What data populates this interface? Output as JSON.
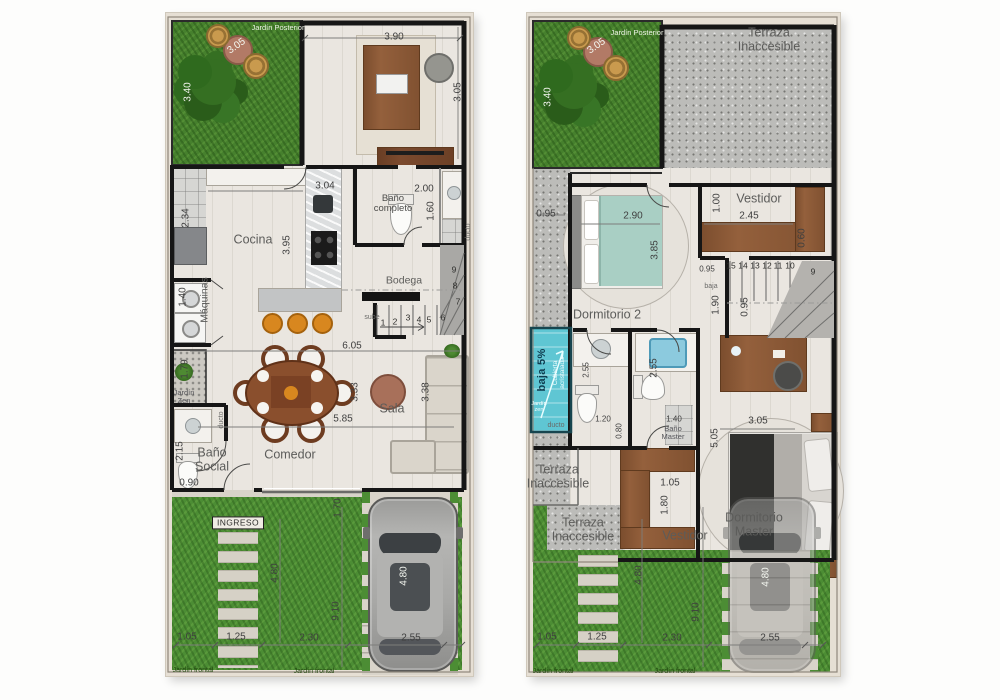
{
  "colors": {
    "grass": "#46802d",
    "front_grass": "#4c8d34",
    "concrete": "#bcbcb9",
    "wall": "#161616",
    "wood": "#94603c",
    "skylight_glass": "#5fc6d3",
    "interior_floor": "#eae6e0"
  },
  "plans": [
    {
      "id": "ground-floor",
      "labels": [
        {
          "t": "Jardín Posterior",
          "x": 112,
          "y": 15,
          "k": "tinyw"
        },
        {
          "t": "3.05",
          "x": 71,
          "y": 34,
          "k": "dimw",
          "r": -35
        },
        {
          "t": "3.40",
          "x": 23,
          "y": 79,
          "k": "dimw",
          "r": -90
        },
        {
          "t": "3.90",
          "x": 228,
          "y": 25,
          "k": "dim"
        },
        {
          "t": "3.05",
          "x": 293,
          "y": 79,
          "k": "dim",
          "r": -90
        },
        {
          "t": "3.04",
          "x": 159,
          "y": 174,
          "k": "dim"
        },
        {
          "t": "Baño\ncompleto",
          "x": 227,
          "y": 191,
          "k": "room2-sm"
        },
        {
          "t": "2.00",
          "x": 258,
          "y": 177,
          "k": "dim"
        },
        {
          "t": "1.60",
          "x": 266,
          "y": 198,
          "k": "dim",
          "r": -90
        },
        {
          "t": "ducto",
          "x": 303,
          "y": 219,
          "k": "tiny",
          "r": -90
        },
        {
          "t": "Cocina",
          "x": 87,
          "y": 227,
          "k": "room"
        },
        {
          "t": "3.95",
          "x": 122,
          "y": 232,
          "k": "dim",
          "r": -90
        },
        {
          "t": "2.34",
          "x": 21,
          "y": 205,
          "k": "dim",
          "r": -90
        },
        {
          "t": "1.40",
          "x": 18,
          "y": 284,
          "k": "dim",
          "r": -90
        },
        {
          "t": "Máquinas",
          "x": 39,
          "y": 287,
          "k": "room-sm",
          "r": -90
        },
        {
          "t": "Bodega",
          "x": 238,
          "y": 268,
          "k": "room-sm"
        },
        {
          "t": "sube",
          "x": 206,
          "y": 305,
          "k": "tiny"
        },
        {
          "t": "1",
          "x": 217,
          "y": 310,
          "k": "step"
        },
        {
          "t": "2",
          "x": 229,
          "y": 309,
          "k": "step"
        },
        {
          "t": "3",
          "x": 242,
          "y": 305,
          "k": "step"
        },
        {
          "t": "4",
          "x": 253,
          "y": 307,
          "k": "step"
        },
        {
          "t": "5",
          "x": 263,
          "y": 307,
          "k": "step"
        },
        {
          "t": "6",
          "x": 277,
          "y": 305,
          "k": "step"
        },
        {
          "t": "7",
          "x": 292,
          "y": 289,
          "k": "step"
        },
        {
          "t": "8",
          "x": 289,
          "y": 273,
          "k": "step"
        },
        {
          "t": "9",
          "x": 288,
          "y": 257,
          "k": "step"
        },
        {
          "t": "6.05",
          "x": 186,
          "y": 334,
          "k": "dim"
        },
        {
          "t": "5.85",
          "x": 177,
          "y": 407,
          "k": "dim"
        },
        {
          "t": "3.33",
          "x": 190,
          "y": 379,
          "k": "dim",
          "r": -90
        },
        {
          "t": "3.38",
          "x": 261,
          "y": 379,
          "k": "dim",
          "r": -90
        },
        {
          "t": "Sala",
          "x": 226,
          "y": 396,
          "k": "room"
        },
        {
          "t": "Comedor",
          "x": 124,
          "y": 442,
          "k": "room"
        },
        {
          "t": "Baño\nSocial",
          "x": 46,
          "y": 447,
          "k": "room2"
        },
        {
          "t": "2.15",
          "x": 15,
          "y": 438,
          "k": "dim",
          "r": -90
        },
        {
          "t": "0.90",
          "x": 23,
          "y": 471,
          "k": "dim"
        },
        {
          "t": "1.79",
          "x": 20,
          "y": 356,
          "k": "dim",
          "r": -90
        },
        {
          "t": "Jardín\nZen",
          "x": 18,
          "y": 384,
          "k": "tiny2"
        },
        {
          "t": "ducto",
          "x": 56,
          "y": 407,
          "k": "tiny",
          "r": -90
        },
        {
          "t": "INGRESO",
          "x": 72,
          "y": 510,
          "k": "ingreso"
        },
        {
          "t": "1.05",
          "x": 21,
          "y": 625,
          "k": "dim"
        },
        {
          "t": "1.25",
          "x": 70,
          "y": 625,
          "k": "dim"
        },
        {
          "t": "2.30",
          "x": 143,
          "y": 626,
          "k": "dim"
        },
        {
          "t": "2.55",
          "x": 245,
          "y": 626,
          "k": "dim"
        },
        {
          "t": "4.80",
          "x": 110,
          "y": 560,
          "k": "dim",
          "r": -90
        },
        {
          "t": "9.10",
          "x": 171,
          "y": 598,
          "k": "dim",
          "r": -90
        },
        {
          "t": "1.70",
          "x": 173,
          "y": 495,
          "k": "dim",
          "r": -90
        },
        {
          "t": "4.80",
          "x": 239,
          "y": 563,
          "k": "dimw",
          "r": -90
        },
        {
          "t": "Jardín frontal",
          "x": 27,
          "y": 658,
          "k": "tinyg"
        },
        {
          "t": "Jardín frontal",
          "x": 148,
          "y": 659,
          "k": "tinyg"
        }
      ]
    },
    {
      "id": "upper-floor",
      "labels": [
        {
          "t": "Jardín Posterior",
          "x": 110,
          "y": 20,
          "k": "tinyw"
        },
        {
          "t": "3.05",
          "x": 70,
          "y": 34,
          "k": "dimw",
          "r": -35
        },
        {
          "t": "3.40",
          "x": 22,
          "y": 84,
          "k": "dimw",
          "r": -90
        },
        {
          "t": "Terraza Inaccesible",
          "x": 242,
          "y": 27,
          "k": "room"
        },
        {
          "t": "0.95",
          "x": 19,
          "y": 202,
          "k": "dim"
        },
        {
          "t": "Vestidor",
          "x": 232,
          "y": 186,
          "k": "room"
        },
        {
          "t": "2.45",
          "x": 222,
          "y": 204,
          "k": "dim"
        },
        {
          "t": "1.00",
          "x": 191,
          "y": 190,
          "k": "dim",
          "r": -90
        },
        {
          "t": "0.60",
          "x": 276,
          "y": 225,
          "k": "dim",
          "r": -90
        },
        {
          "t": "2.90",
          "x": 106,
          "y": 204,
          "k": "dim"
        },
        {
          "t": "3.85",
          "x": 129,
          "y": 237,
          "k": "dim",
          "r": -90
        },
        {
          "t": "Dormitorio 2",
          "x": 80,
          "y": 302,
          "k": "room"
        },
        {
          "t": "15",
          "x": 204,
          "y": 253,
          "k": "step"
        },
        {
          "t": "14",
          "x": 216,
          "y": 253,
          "k": "step"
        },
        {
          "t": "13",
          "x": 228,
          "y": 253,
          "k": "step"
        },
        {
          "t": "12",
          "x": 240,
          "y": 253,
          "k": "step"
        },
        {
          "t": "11",
          "x": 251,
          "y": 253,
          "k": "step"
        },
        {
          "t": "10",
          "x": 263,
          "y": 253,
          "k": "step"
        },
        {
          "t": "9",
          "x": 286,
          "y": 259,
          "k": "step"
        },
        {
          "t": "0.95",
          "x": 180,
          "y": 257,
          "k": "dim-sm"
        },
        {
          "t": "baja",
          "x": 184,
          "y": 274,
          "k": "tiny"
        },
        {
          "t": "1.90",
          "x": 190,
          "y": 292,
          "k": "dim",
          "r": -90
        },
        {
          "t": "0.95",
          "x": 219,
          "y": 294,
          "k": "dim",
          "r": -90
        },
        {
          "t": "baja 5%",
          "x": 16,
          "y": 357,
          "k": "cyanb",
          "r": -90
        },
        {
          "t": "Cubierta\nacristalada",
          "x": 32,
          "y": 360,
          "k": "cyans",
          "r": -90
        },
        {
          "t": "Jardín\nzen",
          "x": 12,
          "y": 395,
          "k": "cyant"
        },
        {
          "t": "ducto",
          "x": 29,
          "y": 413,
          "k": "tiny"
        },
        {
          "t": "2.55",
          "x": 60,
          "y": 357,
          "k": "dim-sm",
          "r": -90
        },
        {
          "t": "2.55",
          "x": 128,
          "y": 355,
          "k": "dim",
          "r": -90
        },
        {
          "t": "1.20",
          "x": 76,
          "y": 407,
          "k": "dim-sm"
        },
        {
          "t": "1.40",
          "x": 147,
          "y": 407,
          "k": "dim-sm"
        },
        {
          "t": "0.80",
          "x": 93,
          "y": 418,
          "k": "dim-sm",
          "r": -90
        },
        {
          "t": "Baño\nMaster",
          "x": 146,
          "y": 420,
          "k": "tiny2"
        },
        {
          "t": "Terraza\nInaccesible",
          "x": 31,
          "y": 464,
          "k": "room2"
        },
        {
          "t": "Terraza\nInaccesible",
          "x": 56,
          "y": 517,
          "k": "room2"
        },
        {
          "t": "3.05",
          "x": 231,
          "y": 409,
          "k": "dim"
        },
        {
          "t": "5.05",
          "x": 189,
          "y": 425,
          "k": "dim",
          "r": -90
        },
        {
          "t": "Dormitorio Master",
          "x": 227,
          "y": 512,
          "k": "room"
        },
        {
          "t": "Vestidor",
          "x": 158,
          "y": 523,
          "k": "room"
        },
        {
          "t": "1.05",
          "x": 143,
          "y": 471,
          "k": "dim"
        },
        {
          "t": "1.80",
          "x": 139,
          "y": 492,
          "k": "dim",
          "r": -90
        },
        {
          "t": "1.05",
          "x": 20,
          "y": 625,
          "k": "dim"
        },
        {
          "t": "1.25",
          "x": 70,
          "y": 625,
          "k": "dim"
        },
        {
          "t": "2.30",
          "x": 145,
          "y": 626,
          "k": "dim"
        },
        {
          "t": "2.55",
          "x": 243,
          "y": 626,
          "k": "dim"
        },
        {
          "t": "4.80",
          "x": 113,
          "y": 562,
          "k": "dim",
          "r": -90
        },
        {
          "t": "9.10",
          "x": 170,
          "y": 599,
          "k": "dim",
          "r": -90
        },
        {
          "t": "4.80",
          "x": 240,
          "y": 564,
          "k": "dimw",
          "r": -90
        },
        {
          "t": "Jardín frontal",
          "x": 26,
          "y": 659,
          "k": "tinyg"
        },
        {
          "t": "Jardín frontal",
          "x": 148,
          "y": 659,
          "k": "tinyg"
        }
      ]
    }
  ]
}
